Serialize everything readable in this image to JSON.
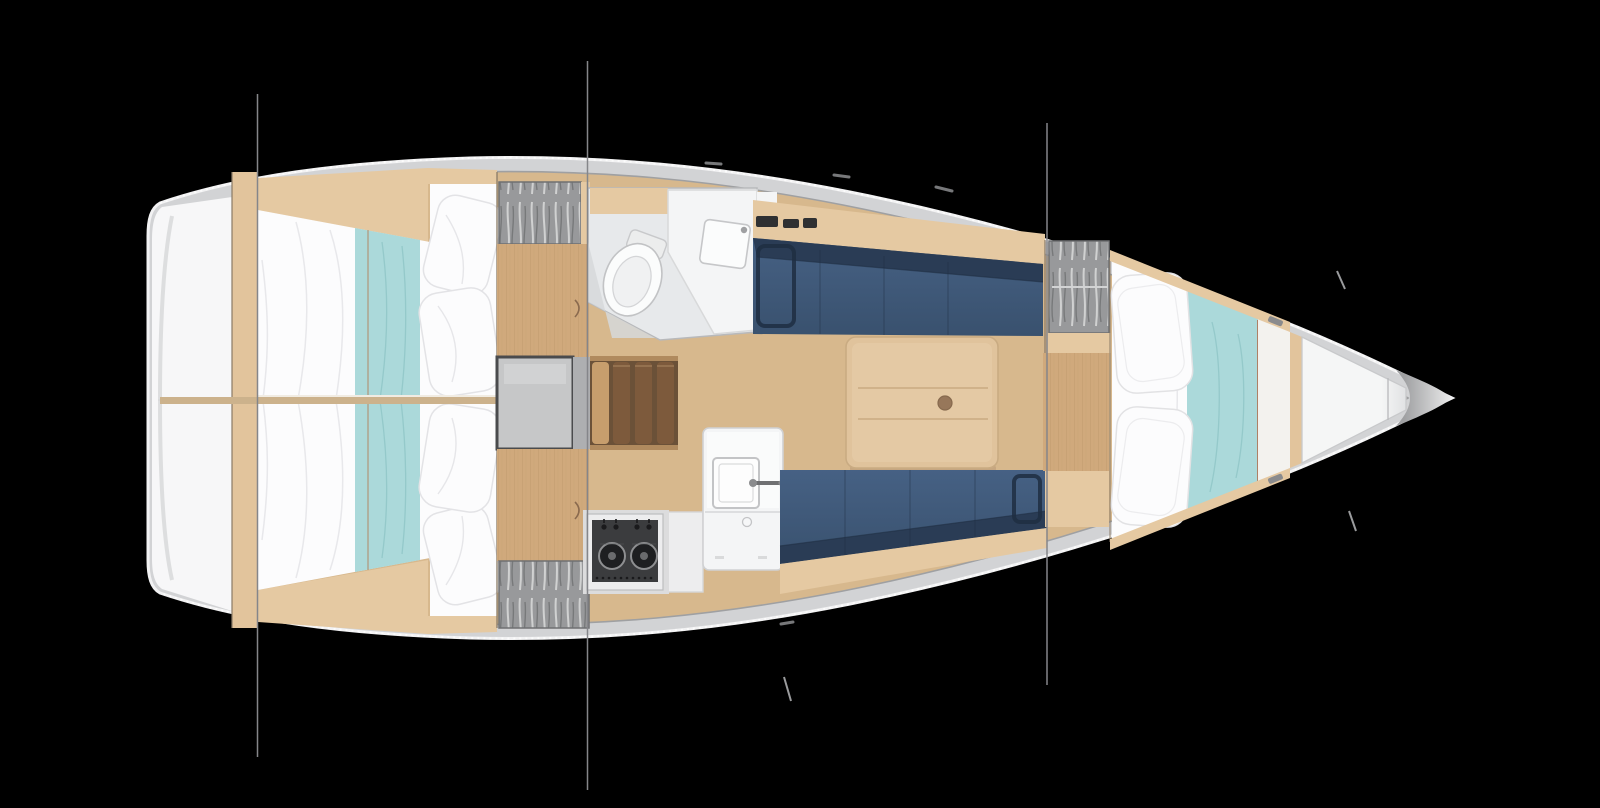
{
  "scene": {
    "subject": "sailboat-interior-floor-plan",
    "view": "top-down",
    "bow_direction": "right",
    "cabins_visible": 3,
    "rigging_line_x_positions": [
      257,
      587,
      1047
    ]
  },
  "features": [
    "hull-outline",
    "bow-anchor-locker",
    "stern-compartment",
    "aft-cabin-port-berth",
    "aft-cabin-starboard-berth",
    "hanging-locker-aft-port",
    "hanging-locker-aft-starboard",
    "engine-compartment",
    "companionway-steps",
    "head-with-toilet-and-sink",
    "salon-settee-port",
    "salon-settee-starboard",
    "salon-table",
    "galley-sink-unit",
    "galley-two-burner-stove",
    "hanging-locker-forward",
    "v-berth-forward-cabin",
    "mast-and-rigging-lines"
  ],
  "colors": {
    "background": "#000000",
    "hull_band": "#d2d3d5",
    "hull_edge": "#f2f2f3",
    "deck_line": "#9fa0a2",
    "bow_cap_dark": "#9fa0a2",
    "bow_cap_light": "#ececec",
    "stern_white": "#f7f7f8",
    "wood_floor": "#d7b88d",
    "wood_trim": "#e5c9a2",
    "wood_sole": "#d0a97c",
    "wood_grain": "#c09a6d",
    "wood_post": "#e2c49c",
    "table_wood": "#e0c39c",
    "table_edge": "#c9ab82",
    "table_knob": "#97775a",
    "divider_wood": "#ccb28c",
    "step_dark": "#7d5a3c",
    "step_light": "#c79e6d",
    "step_rail": "#b08a5e",
    "navy": "#3d5776",
    "navy_dark": "#2a3c55",
    "navy_line": "#1f2e42",
    "teal": "#abd9da",
    "teal_line": "#8fc4c6",
    "white_fabric": "#fcfcfd",
    "fabric_line": "#e6e6e9",
    "locker_gray": "#98999b",
    "locker_light": "#d6d7d8",
    "locker_dark": "#6f7072",
    "head_floor": "#e7e9eb",
    "head_shadow": "#d6d8da",
    "fixture_white": "#f4f5f6",
    "fixture_line": "#c6c7c9",
    "engine_gray": "#c6c7c8",
    "engine_edge": "#4a4b4d",
    "hatch_gray": "#aeafb1",
    "stove_dark": "#3b3c3e",
    "stove_frame": "#ededee",
    "burner_dark": "#1e1f21",
    "metal_gray": "#6f7072",
    "rig_line": "#85868a",
    "accent_seam": "#b06a4a",
    "forepeak_white": "#f5f6f6",
    "forepeak_shade": "#dfe0e2"
  }
}
